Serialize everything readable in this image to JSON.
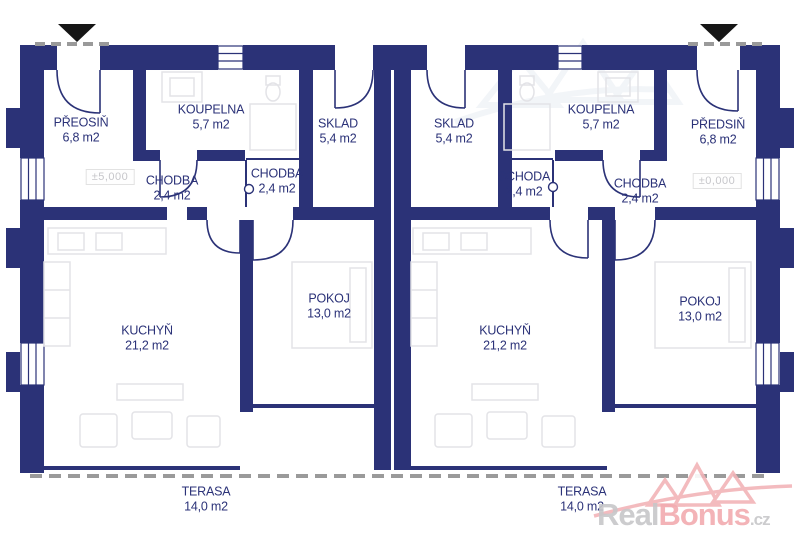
{
  "rooms": {
    "predsin_left": {
      "name": "PŘEOSIŇ",
      "area": "6,8 m2"
    },
    "koupelna_left": {
      "name": "KOUPELNA",
      "area": "5,7 m2"
    },
    "sklad_left": {
      "name": "SKLAD",
      "area": "5,4 m2"
    },
    "chodba_left_main": {
      "name": "CHODBA",
      "area": "2,4 m2"
    },
    "chodba_left_small": {
      "name": "CHODBA",
      "area": "2,4 m2"
    },
    "kuchyn_left": {
      "name": "KUCHYŇ",
      "area": "21,2 m2"
    },
    "pokoj_left": {
      "name": "POKOJ",
      "area": "13,0 m2"
    },
    "terasa_left": {
      "name": "TERASA",
      "area": "14,0 m2"
    },
    "sklad_right": {
      "name": "SKLAD",
      "area": "5,4 m2"
    },
    "koupelna_right": {
      "name": "KOUPELNA",
      "area": "5,7 m2"
    },
    "predsin_right": {
      "name": "PŘEDSIŇ",
      "area": "6,8 m2"
    },
    "schoda_right": {
      "name": "SCHODA",
      "area": "2,4 m2"
    },
    "chodba_right_main": {
      "name": "CHODBA",
      "area": "2,4 m2"
    },
    "kuchyn_right": {
      "name": "KUCHYŇ",
      "area": "21,2 m2"
    },
    "pokoj_right": {
      "name": "POKOJ",
      "area": "13,0 m2"
    },
    "terasa_right": {
      "name": "TERASA",
      "area": "14,0 m2"
    }
  },
  "markers": {
    "elevation_left": "±5,000",
    "elevation_right": "±0,000"
  },
  "watermark": {
    "real": "Real",
    "bonus": "Bonus",
    "tld": ".cz"
  },
  "colors": {
    "wall": "#2b3277",
    "label_text": "#2b3278",
    "furniture": "#e3e3e7",
    "dash": "#9a9a9a",
    "entrance_triangle": "#161616",
    "marker_text": "#c6c6ca",
    "watermark_gray": "#c7c7c9",
    "watermark_pink": "#f2abb0"
  }
}
